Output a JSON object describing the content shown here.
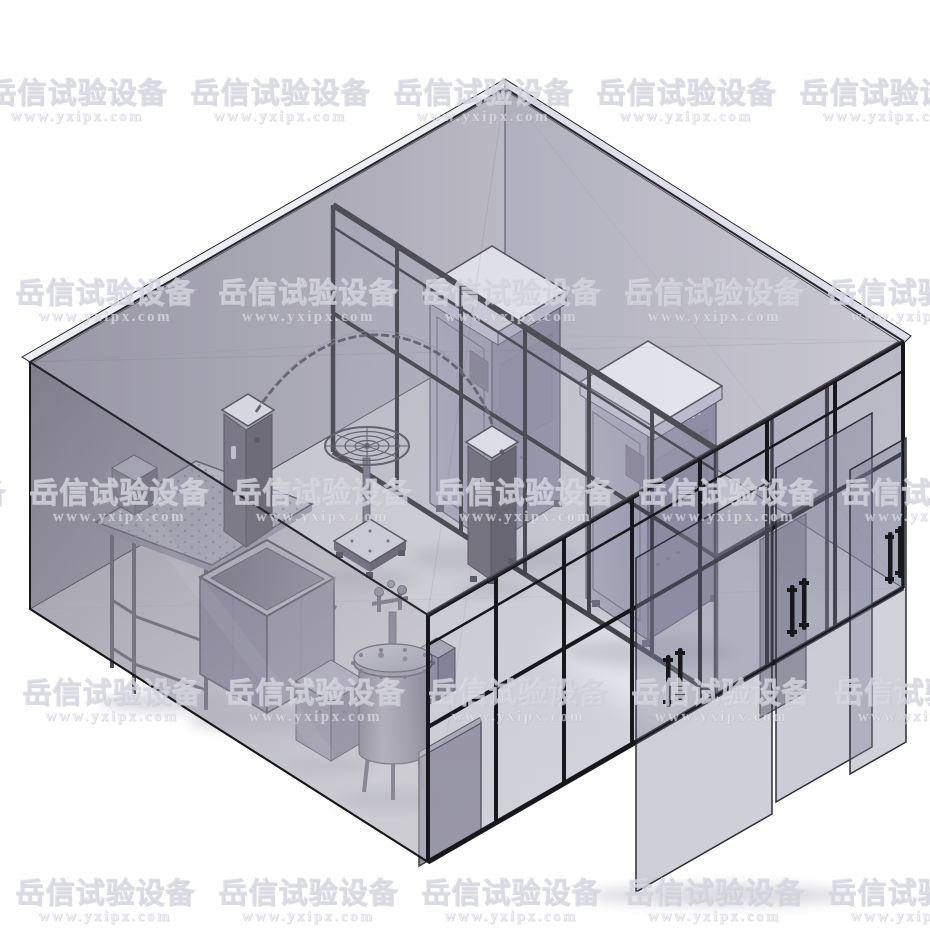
{
  "watermark": {
    "text": "岳信试验设备",
    "url": "www.yxipx.com",
    "tile_width": 203,
    "rows": [
      {
        "top": 78,
        "offset": 179
      },
      {
        "top": 278,
        "offset": 4
      },
      {
        "top": 478,
        "offset": 18
      },
      {
        "top": 678,
        "offset": 11
      },
      {
        "top": 878,
        "offset": 4
      }
    ],
    "text_color": "rgba(255,255,255,0.17)",
    "outline_color": "rgba(213,213,224,0.62)",
    "url_color": "rgba(245,245,250,0.55)"
  },
  "palette": {
    "background": "#ffffff",
    "frame_black": "#17171c",
    "roof_gray": "#b4b3c1",
    "wall_nw_gray": "#9a98a6",
    "wall_ne_gray": "#bdbcc8",
    "front_wall_gray": "#a5a2b0",
    "floor_gray": "#d7d7db",
    "glass_tint": "#9a9cb2",
    "equipment_gray": "#8d8a9e",
    "equipment_dark": "#55525f",
    "cabinet_top_white": "#f2f4fb"
  }
}
